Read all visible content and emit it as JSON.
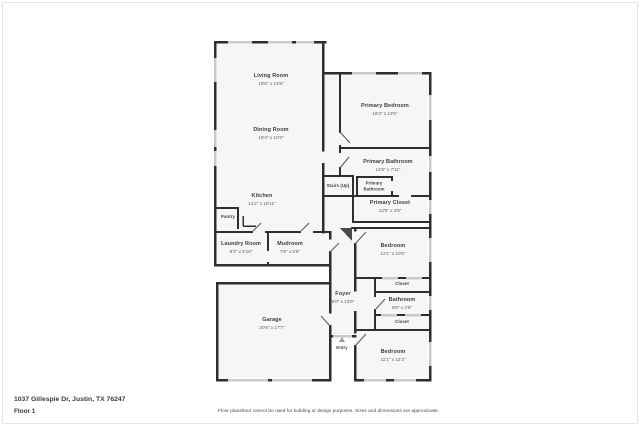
{
  "page": {
    "title": "Floor plan"
  },
  "colors": {
    "wall": "#2e2e2e",
    "window": "#c9c9c9",
    "floor": "#f6f6f6",
    "page_background": "#ffffff",
    "frame_border": "#e6e6e6",
    "label_text": "#3d3d3d"
  },
  "rooms": {
    "living_room": {
      "name": "Living Room",
      "dims": "19'6\" x 13'9\""
    },
    "dining_room": {
      "name": "Dining Room",
      "dims": "19'4\" x 10'3\""
    },
    "kitchen": {
      "name": "Kitchen",
      "dims": "14'2\" x 10'11\""
    },
    "pantry": {
      "name": "Pantry"
    },
    "laundry_room": {
      "name": "Laundry Room",
      "dims": "9'2\" x 5'10\""
    },
    "mudroom": {
      "name": "Mudroom",
      "dims": "7'6\" x 5'9\""
    },
    "primary_bedroom": {
      "name": "Primary Bedroom",
      "dims": "16'4\" x 13'5\""
    },
    "primary_bathroom": {
      "name": "Primary Bathroom",
      "dims": "14'5\" x 7'11\""
    },
    "stairs": {
      "name": "Stairs (Up)"
    },
    "primary_bathroom_wc": {
      "name": "Primary Bathroom"
    },
    "primary_closet": {
      "name": "Primary Closet",
      "dims": "13'8\" x 4'8\""
    },
    "bedroom_1": {
      "name": "Bedroom",
      "dims": "12'1\" x 10'5\""
    },
    "closet_1": {
      "name": "Closet"
    },
    "bathroom": {
      "name": "Bathroom",
      "dims": "9'6\" x 4'9\""
    },
    "closet_2": {
      "name": "Closet"
    },
    "bedroom_2": {
      "name": "Bedroom",
      "dims": "11'1\" x 12'3\""
    },
    "foyer": {
      "name": "Foyer",
      "dims": "5'0\" x 13'9\""
    },
    "entry": {
      "name": "Entry"
    },
    "garage": {
      "name": "Garage",
      "dims": "20'6\" x 17'7\""
    }
  },
  "footer": {
    "address": "1037 Gillespie Dr, Justin, TX 76247",
    "floor": "Floor 1",
    "disclaimer": "Floor plans/tour cannot be used for building or design purposes. Sizes and dimensions are approximate."
  }
}
